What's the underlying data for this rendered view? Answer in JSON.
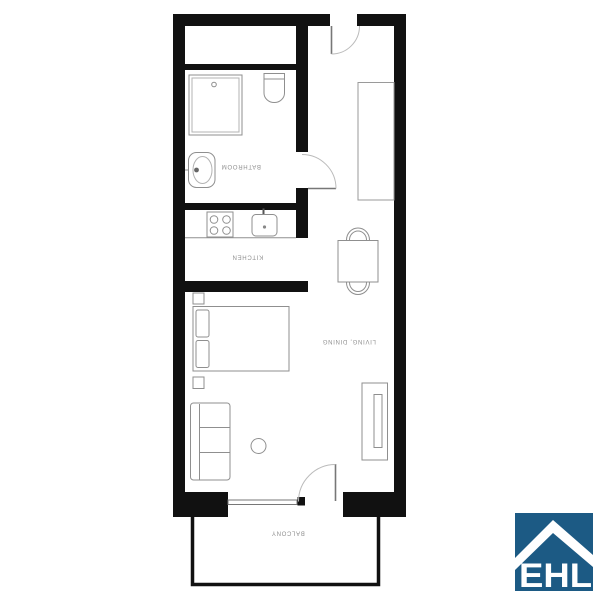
{
  "floorplan": {
    "labels": {
      "bathroom": "BATHROOM",
      "kitchen": "KITCHEN",
      "living_dining": "LIVING, DINING",
      "balcony": "BALCONY"
    },
    "colors": {
      "wall": "#111111",
      "furniture_outline": "#8f8f8f",
      "label_text": "#8f8f8f",
      "background": "#ffffff"
    },
    "furniture_icons": [
      "shower-icon",
      "toilet-icon",
      "bathroom-sink-icon",
      "wardrobe-icon",
      "stove-icon",
      "kitchen-sink-icon",
      "dining-table-icon",
      "chair-icon",
      "bed-icon",
      "pillow-icon",
      "nightstand-icon",
      "sofa-icon",
      "coffee-table-icon",
      "tv-board-icon",
      "door-swing-icon",
      "window-icon"
    ]
  },
  "logo": {
    "text": "EHL",
    "icon": "house-roof-icon",
    "colors": {
      "background": "#1c5a84",
      "foreground": "#ffffff"
    }
  }
}
